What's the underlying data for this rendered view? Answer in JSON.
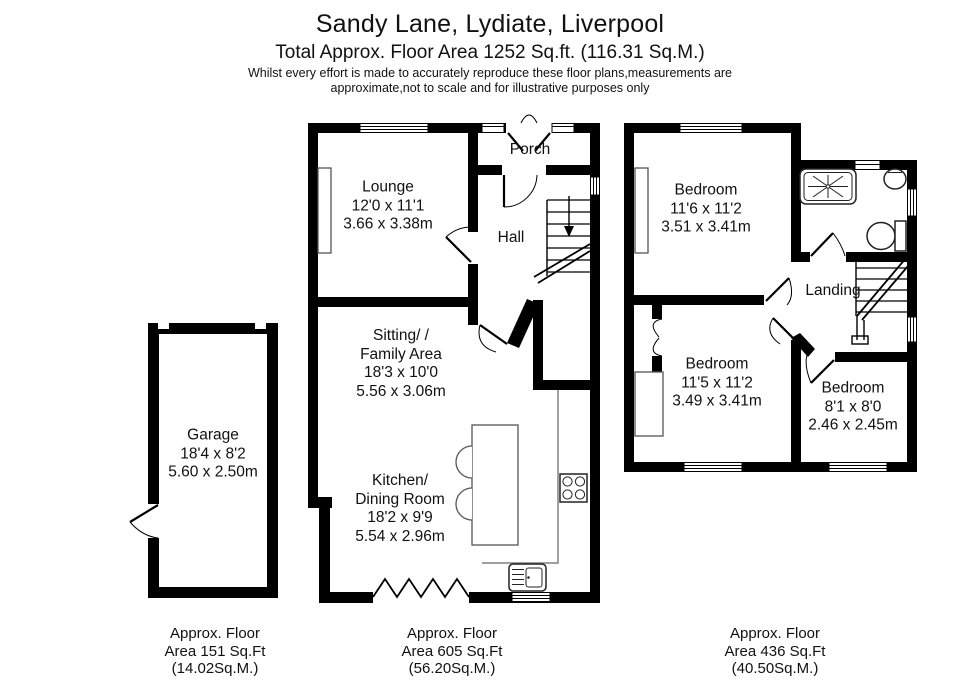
{
  "header": {
    "title": "Sandy Lane, Lydiate, Liverpool",
    "subtitle": "Total Approx. Floor Area 1252 Sq.ft. (116.31 Sq.M.)",
    "disclaimer": [
      "Whilst every effort is made to accurately reproduce these floor plans,measurements are",
      "approximate,not to scale and for illustrative purposes only"
    ]
  },
  "garage_plan": {
    "room": [
      "Garage",
      "18'4 x 8'2",
      "5.60 x 2.50m"
    ],
    "footer": [
      "Approx. Floor",
      "Area 151 Sq.Ft",
      "(14.02Sq.M.)"
    ]
  },
  "ground_floor_plan": {
    "lounge": [
      "Lounge",
      "12'0 x 11'1",
      "3.66 x 3.38m"
    ],
    "porch": "Porch",
    "hall": "Hall",
    "sitting": [
      "Sitting/ /",
      "Family Area",
      "18'3 x 10'0",
      "5.56 x 3.06m"
    ],
    "kitchen": [
      "Kitchen/",
      "Dining Room",
      "18'2 x 9'9",
      "5.54 x 2.96m"
    ],
    "footer": [
      "Approx. Floor",
      "Area 605 Sq.Ft",
      "(56.20Sq.M.)"
    ]
  },
  "first_floor_plan": {
    "bedroom1": [
      "Bedroom",
      "11'6 x 11'2",
      "3.51 x 3.41m"
    ],
    "landing": "Landing",
    "bedroom2": [
      "Bedroom",
      "11'5 x 11'2",
      "3.49 x 3.41m"
    ],
    "bedroom3": [
      "Bedroom",
      "8'1 x 8'0",
      "2.46 x 2.45m"
    ],
    "footer": [
      "Approx. Floor",
      "Area 436 Sq.Ft",
      "(40.50Sq.M.)"
    ]
  },
  "colors": {
    "wall": "#000000",
    "fixture": "#222222",
    "furniture": "#555555",
    "counter": "#808080",
    "background": "#ffffff"
  }
}
